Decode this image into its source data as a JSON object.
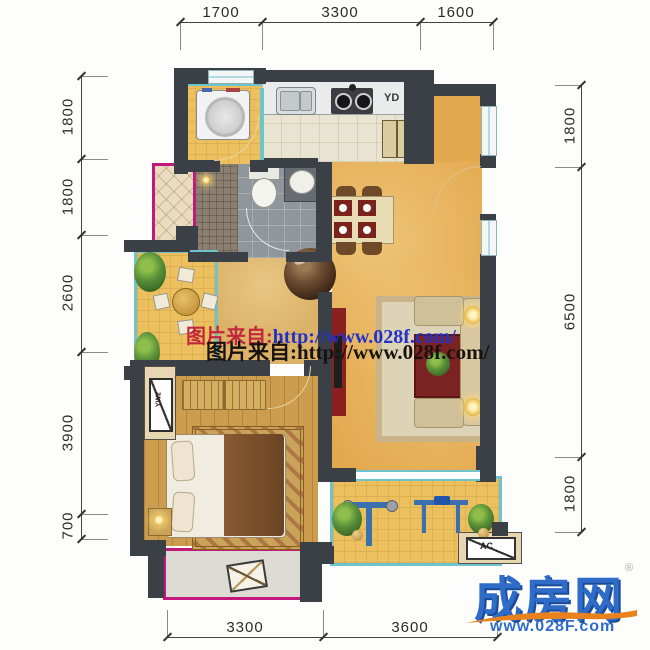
{
  "dimensions": {
    "top": [
      "1700",
      "3300",
      "1600"
    ],
    "bottom": [
      "3300",
      "3600"
    ],
    "left": [
      "1800",
      "1800",
      "2600",
      "3900",
      "700"
    ],
    "right": [
      "1800",
      "6500",
      "1800"
    ]
  },
  "labels": {
    "flue": "YD",
    "ac": "AC",
    "ac_side": "YW2"
  },
  "watermark": {
    "line1_prefix": "图片来自:",
    "line1_url": "http://www.028f.com/",
    "line2": "图片来自:http://www.028f.com/"
  },
  "logo": {
    "brand": "成房网",
    "url": "www.028F.com",
    "registered": "®"
  },
  "colors": {
    "wall": "#3a4046",
    "window_teal": "#6fc3cd",
    "balcony_pink": "#c1187e",
    "floor_yellow": "#ecc05e",
    "floor_orange": "#e3a94f",
    "floor_wood": "#cc9d4f",
    "watermark_red": "#c2283c",
    "watermark_blue": "#2331c8",
    "logo_blue": "#2e6cc8",
    "logo_orange": "#e8821e"
  }
}
